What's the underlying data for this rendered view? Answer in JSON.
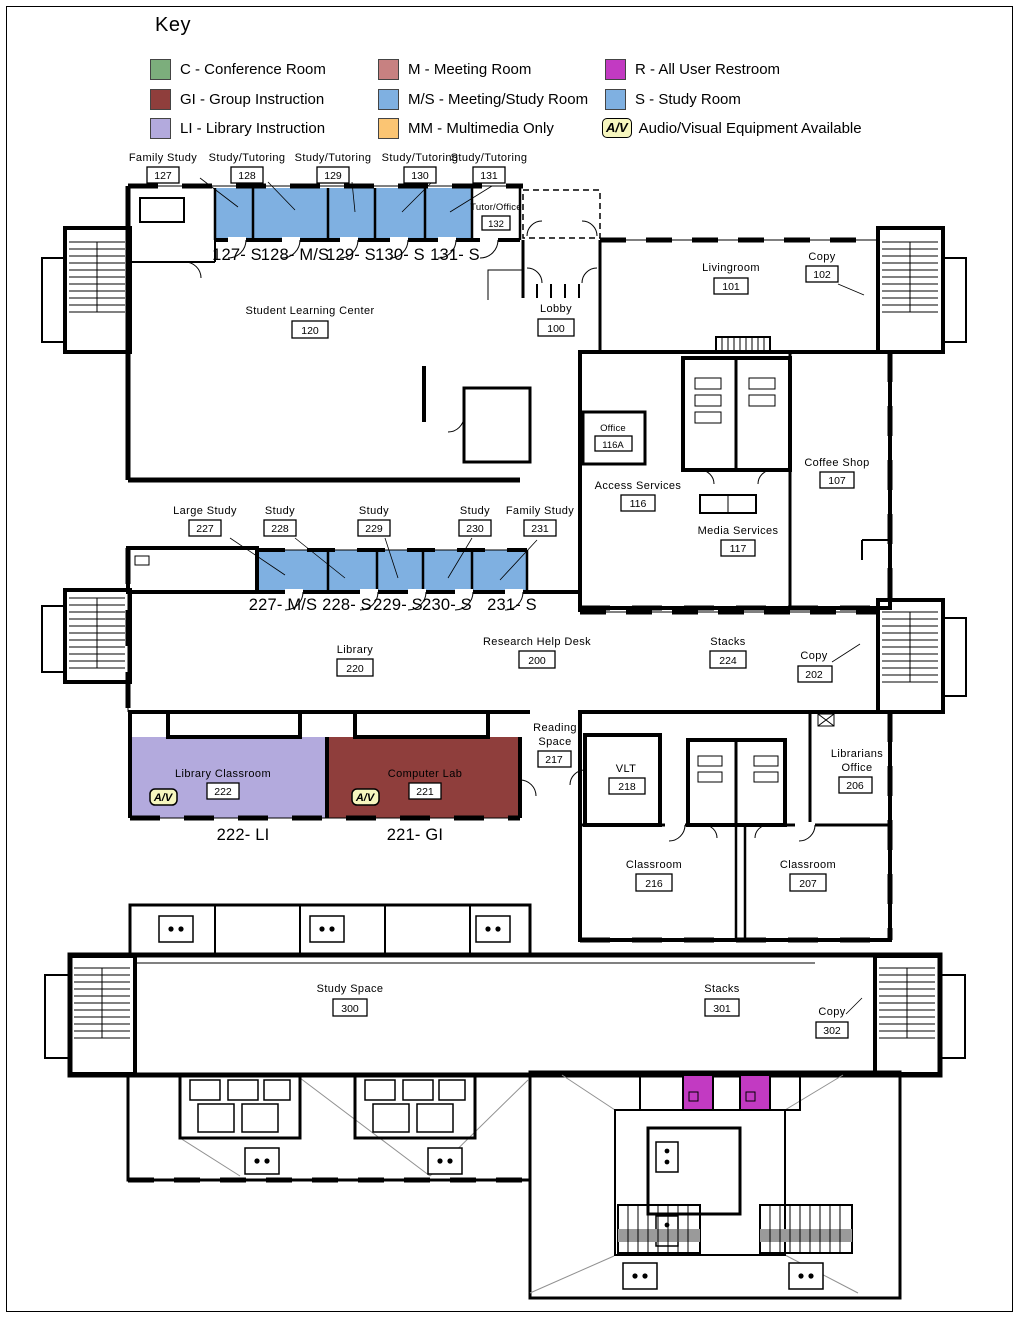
{
  "key": {
    "title": "Key",
    "items": [
      {
        "label": "C - Conference Room"
      },
      {
        "label": "GI - Group Instruction"
      },
      {
        "label": "LI - Library Instruction"
      },
      {
        "label": "M - Meeting Room"
      },
      {
        "label": "M/S - Meeting/Study Room"
      },
      {
        "label": "MM - Multimedia Only"
      },
      {
        "label": "R - All User Restroom"
      },
      {
        "label": "S - Study Room"
      },
      {
        "label": "Audio/Visual Equipment Available",
        "badge": "A/V"
      }
    ]
  },
  "colors": {
    "conference_green": "#7cae7c",
    "group_instruction_red": "#8f3e3c",
    "library_instruction_purple": "#b3aadd",
    "meeting_rose": "#c78181",
    "meeting_study_blue": "#7fb0e1",
    "multimedia_orange": "#fbc573",
    "restroom_magenta": "#c23ac2",
    "study_blue": "#7fb0e1",
    "av_yellow": "#f6f6be",
    "red_label": "#c0392b"
  },
  "floor1": {
    "callouts": [
      {
        "name": "Family Study",
        "number": "127"
      },
      {
        "name": "Study/Tutoring",
        "number": "128"
      },
      {
        "name": "Study/Tutoring",
        "number": "129"
      },
      {
        "name": "Study/Tutoring",
        "number": "130"
      },
      {
        "name": "Study/Tutoring",
        "number": "131"
      }
    ],
    "red_labels": [
      "127- S",
      "128- M/S",
      "129- S",
      "130- S",
      "131- S"
    ],
    "tutor_office": {
      "name": "Tutor/Office",
      "number": "132"
    },
    "student_learning_center": {
      "name": "Student Learning Center",
      "number": "120"
    },
    "lobby": {
      "name": "Lobby",
      "number": "100"
    },
    "livingroom": {
      "name": "Livingroom",
      "number": "101"
    },
    "copy": {
      "name": "Copy",
      "number": "102"
    },
    "office": {
      "name": "Office",
      "number": "116A"
    },
    "access_services": {
      "name": "Access Services",
      "number": "116"
    },
    "media_services": {
      "name": "Media Services",
      "number": "117"
    },
    "coffee_shop": {
      "name": "Coffee Shop",
      "number": "107"
    }
  },
  "floor2": {
    "callouts": [
      {
        "name": "Large Study",
        "number": "227"
      },
      {
        "name": "Study",
        "number": "228"
      },
      {
        "name": "Study",
        "number": "229"
      },
      {
        "name": "Study",
        "number": "230"
      },
      {
        "name": "Family Study",
        "number": "231"
      }
    ],
    "red_labels": [
      "227- M/S",
      "228- S",
      "229- S",
      "230- S",
      "231- S"
    ],
    "library": {
      "name": "Library",
      "number": "220"
    },
    "research_help_desk": {
      "name": "Research Help Desk",
      "number": "200"
    },
    "stacks": {
      "name": "Stacks",
      "number": "224"
    },
    "copy": {
      "name": "Copy",
      "number": "202"
    },
    "reading_space": {
      "line1": "Reading",
      "line2": "Space",
      "number": "217"
    },
    "vlt": {
      "name": "VLT",
      "number": "218"
    },
    "library_classroom": {
      "name": "Library Classroom",
      "number": "222",
      "red_label": "222- LI"
    },
    "computer_lab": {
      "name": "Computer Lab",
      "number": "221",
      "red_label": "221- GI"
    },
    "librarians_office": {
      "line1": "Librarians",
      "line2": "Office",
      "number": "206"
    },
    "classroom_216": {
      "name": "Classroom",
      "number": "216"
    },
    "classroom_207": {
      "name": "Classroom",
      "number": "207"
    },
    "av_badge": "A/V"
  },
  "floor3": {
    "study_space": {
      "name": "Study Space",
      "number": "300"
    },
    "stacks": {
      "name": "Stacks",
      "number": "301"
    },
    "copy": {
      "name": "Copy",
      "number": "302"
    }
  }
}
